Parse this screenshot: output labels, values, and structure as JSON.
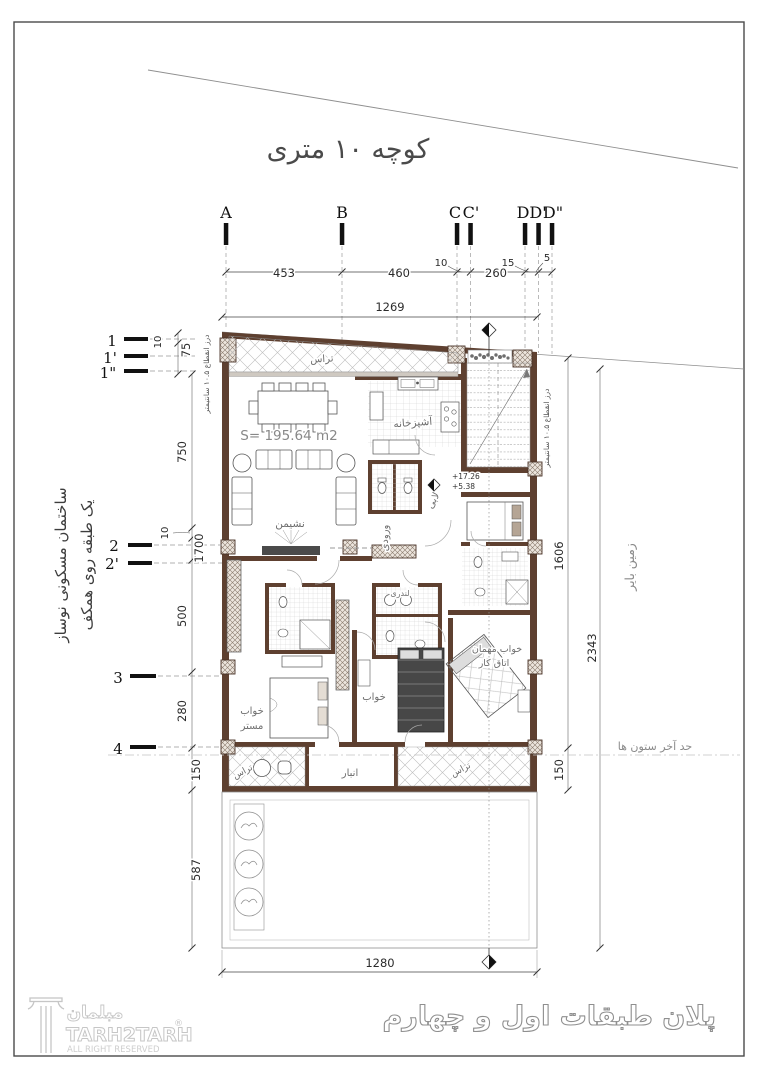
{
  "street": {
    "name": "کوچه ۱۰ متری"
  },
  "grid": {
    "cols": [
      {
        "label": "A"
      },
      {
        "label": "B"
      },
      {
        "label": "C"
      },
      {
        "label": "C'"
      },
      {
        "label": "D"
      },
      {
        "label": "D'"
      },
      {
        "label": "D\""
      }
    ],
    "rows": [
      {
        "label": "1"
      },
      {
        "label": "1'"
      },
      {
        "label": "1\""
      },
      {
        "label": "2"
      },
      {
        "label": "2'"
      },
      {
        "label": "3"
      },
      {
        "label": "4"
      }
    ]
  },
  "dims": {
    "top": {
      "ab": "453",
      "bc": "460",
      "cgap": "10",
      "cd": "260",
      "dgap": "15",
      "dgap2": "5"
    },
    "lot_width": "1269",
    "left": {
      "j10": "10",
      "j75": "75",
      "v750": "750",
      "v10": "10",
      "v1700": "1700",
      "v500": "500",
      "v280": "280",
      "v150": "150",
      "v587": "587"
    },
    "right": {
      "v1606": "1606",
      "v150": "150",
      "v2343": "2343"
    },
    "bottom": {
      "width": "1280"
    }
  },
  "plan": {
    "area": "S=  195.64  m2",
    "levels": {
      "upper": "+17.26",
      "lower": "+5.38"
    },
    "rooms": {
      "terrace_top": "تراس",
      "kitchen": "آشپزخانه",
      "living": "نشیمن",
      "entry": "ورودی",
      "lobby": "لابی",
      "laundry": "لندری",
      "guest_line1": "خواب مهمان",
      "guest_line2": "اتاق کار",
      "master_line1": "خواب",
      "master_line2": "مستر",
      "bedroom": "خواب",
      "storage": "انبار",
      "terrace_left": "تراس",
      "terrace_right": "تراس"
    }
  },
  "site": {
    "vacant_land": "زمین بایر",
    "columns_limit": "حد آخر ستون ها",
    "building_note1": "ساختمان مسکونی نوساز",
    "building_note2": "یک طبقه روی همکف",
    "expansion_joint": "درز انقطاع ۱۰.۵ سانتیمتر"
  },
  "title": {
    "text": "پلان طبقات اول و چهارم"
  },
  "brand": {
    "fa": "مبلمان",
    "en": "TARH2TARH",
    "reg": "®",
    "rights": "ALL RIGHT RESERVED"
  }
}
